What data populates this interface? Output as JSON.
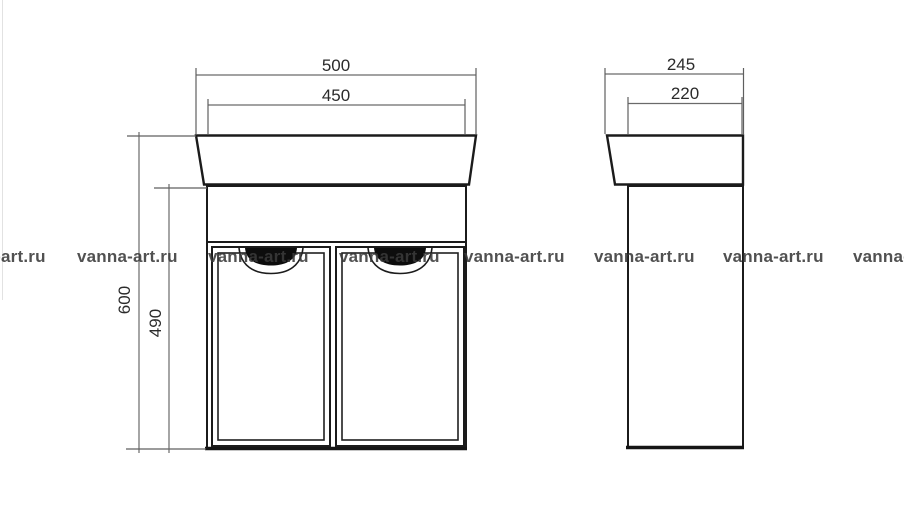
{
  "watermark": {
    "text": "vanna-art.ru"
  },
  "front_view": {
    "dim_width_outer": "500",
    "dim_width_inner": "450",
    "dim_height_total": "600",
    "dim_height_cabinet": "490"
  },
  "side_view": {
    "dim_depth_outer": "245",
    "dim_depth_inner": "220"
  }
}
